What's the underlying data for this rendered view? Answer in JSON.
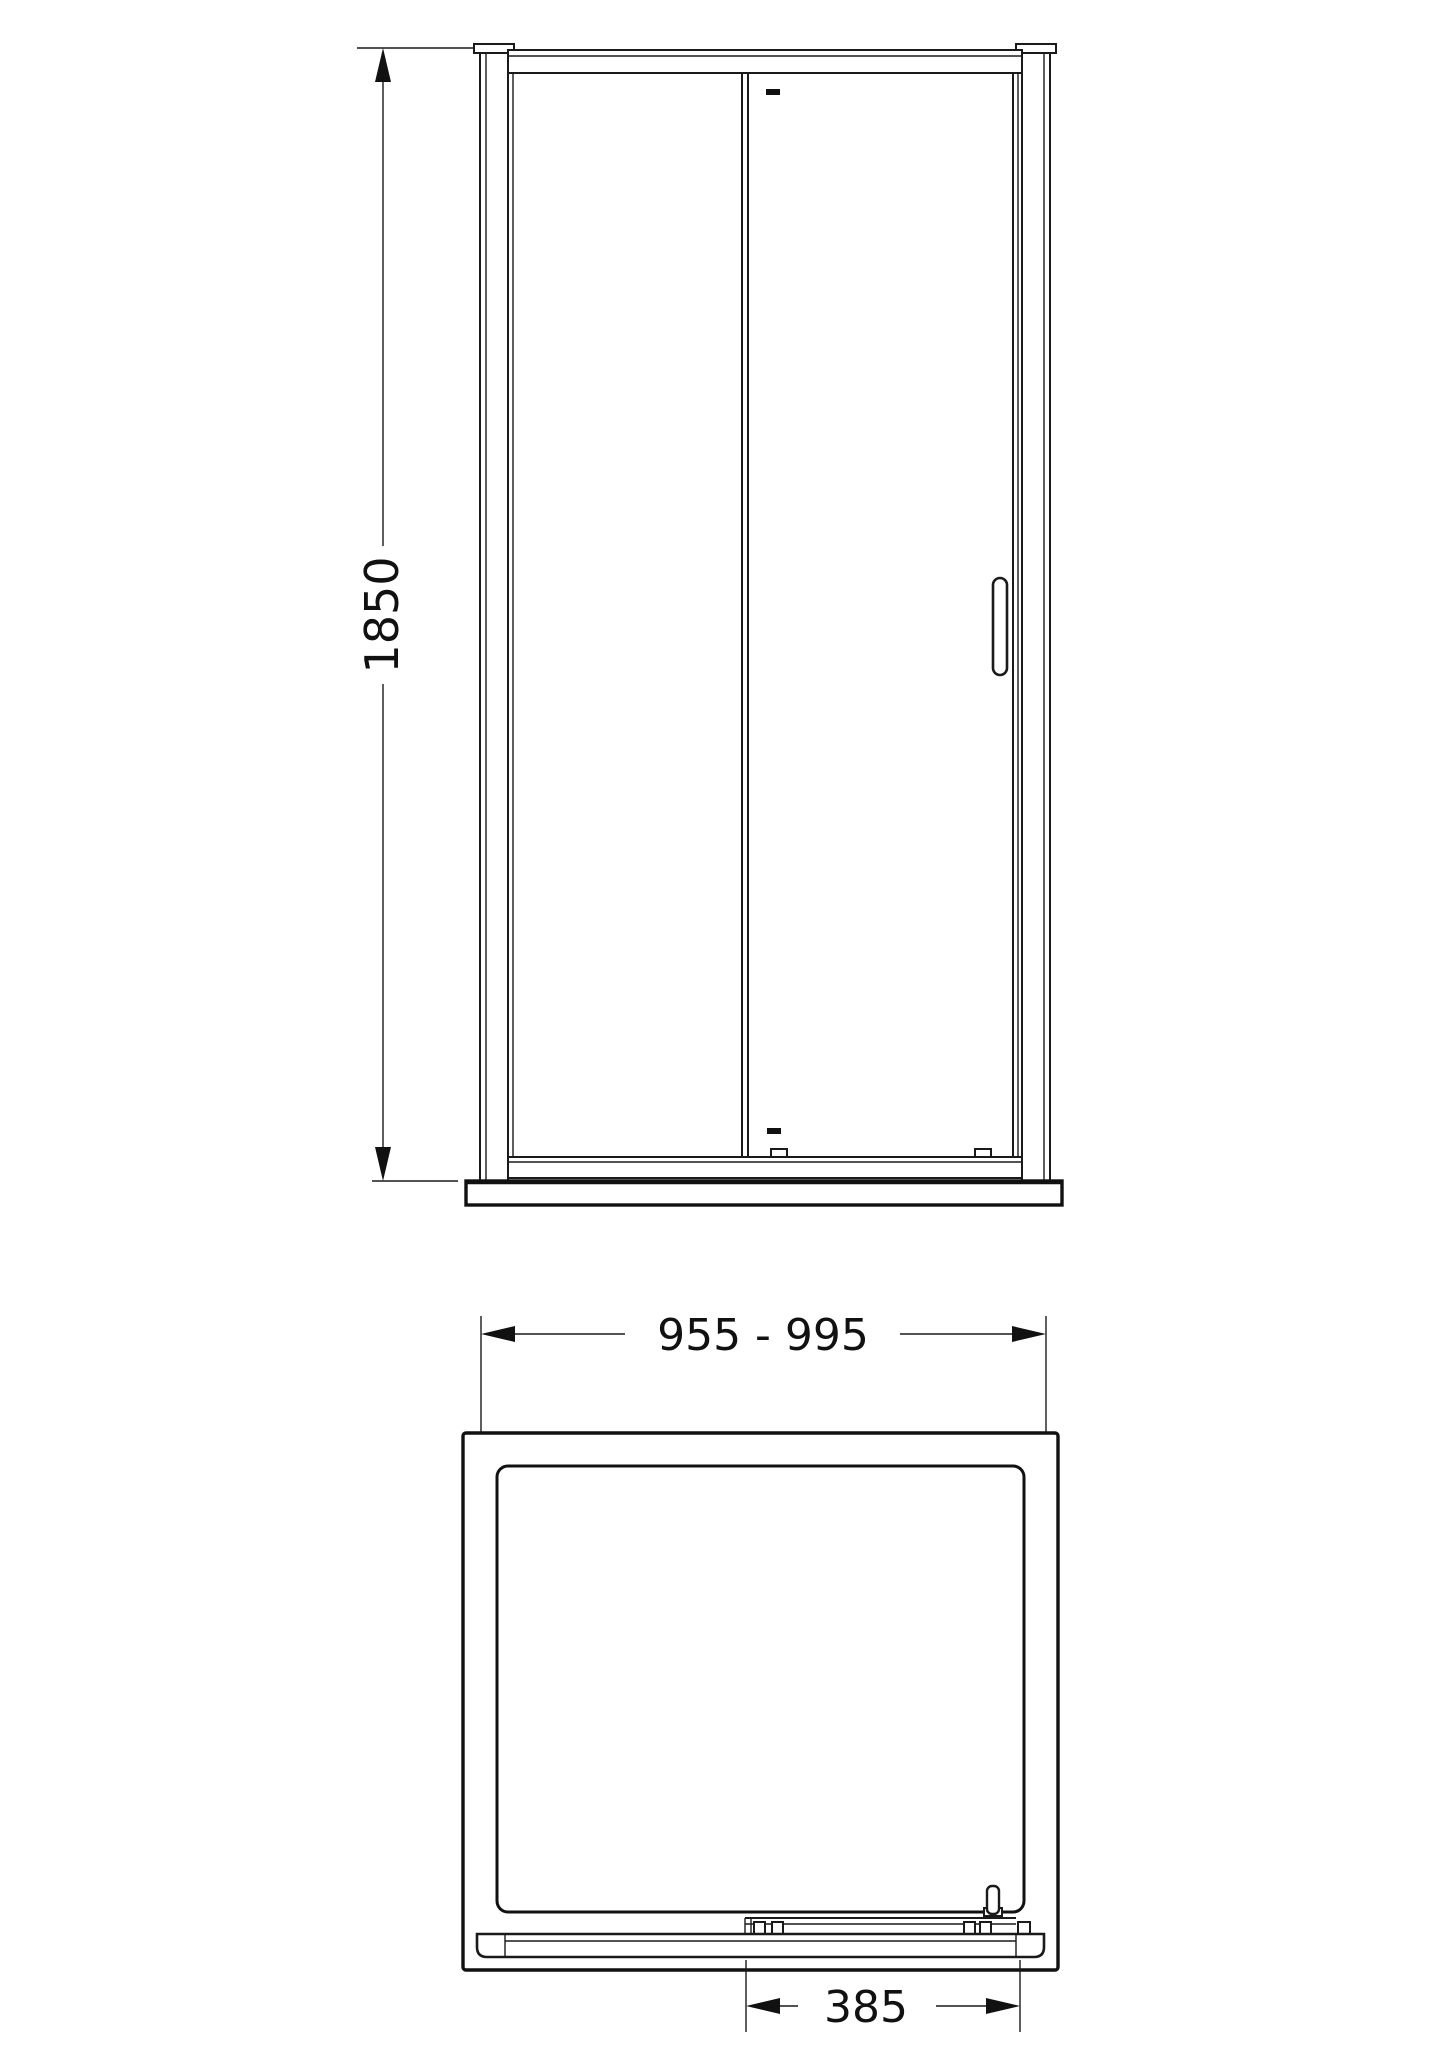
{
  "document": {
    "type": "technical-drawing",
    "subject": "sliding shower door with tray",
    "views": [
      "front-elevation",
      "plan-view"
    ]
  },
  "colors": {
    "background": "#ffffff",
    "line": "#1a1a1a",
    "text": "#111111"
  },
  "elevation": {
    "height_label": "1850"
  },
  "plan": {
    "width_label": "955 - 995",
    "opening_label": "385"
  }
}
